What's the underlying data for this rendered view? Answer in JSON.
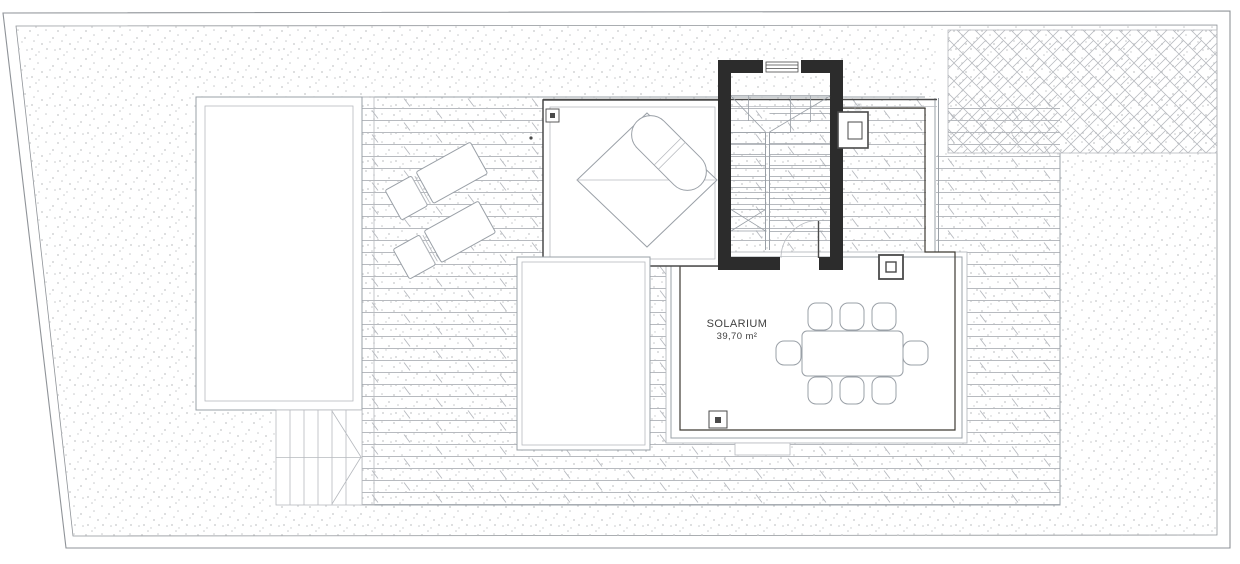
{
  "labels": {
    "solarium_name": "SOLARIUM",
    "solarium_area": "39,70 m²"
  },
  "colors": {
    "paper": "#ffffff",
    "boundary": "#8f9398",
    "line_dark": "#4a4a4a",
    "line_mid": "#9aa0a7",
    "line_light": "#b7babf",
    "wall_dark": "#2c2c2c",
    "solarium_fill": "#dbc78e",
    "solarium_grid": "#c9b274",
    "solarium_edge": "#3e3a33",
    "stipple_dot": "#c6c8ca",
    "text": "#414141"
  }
}
